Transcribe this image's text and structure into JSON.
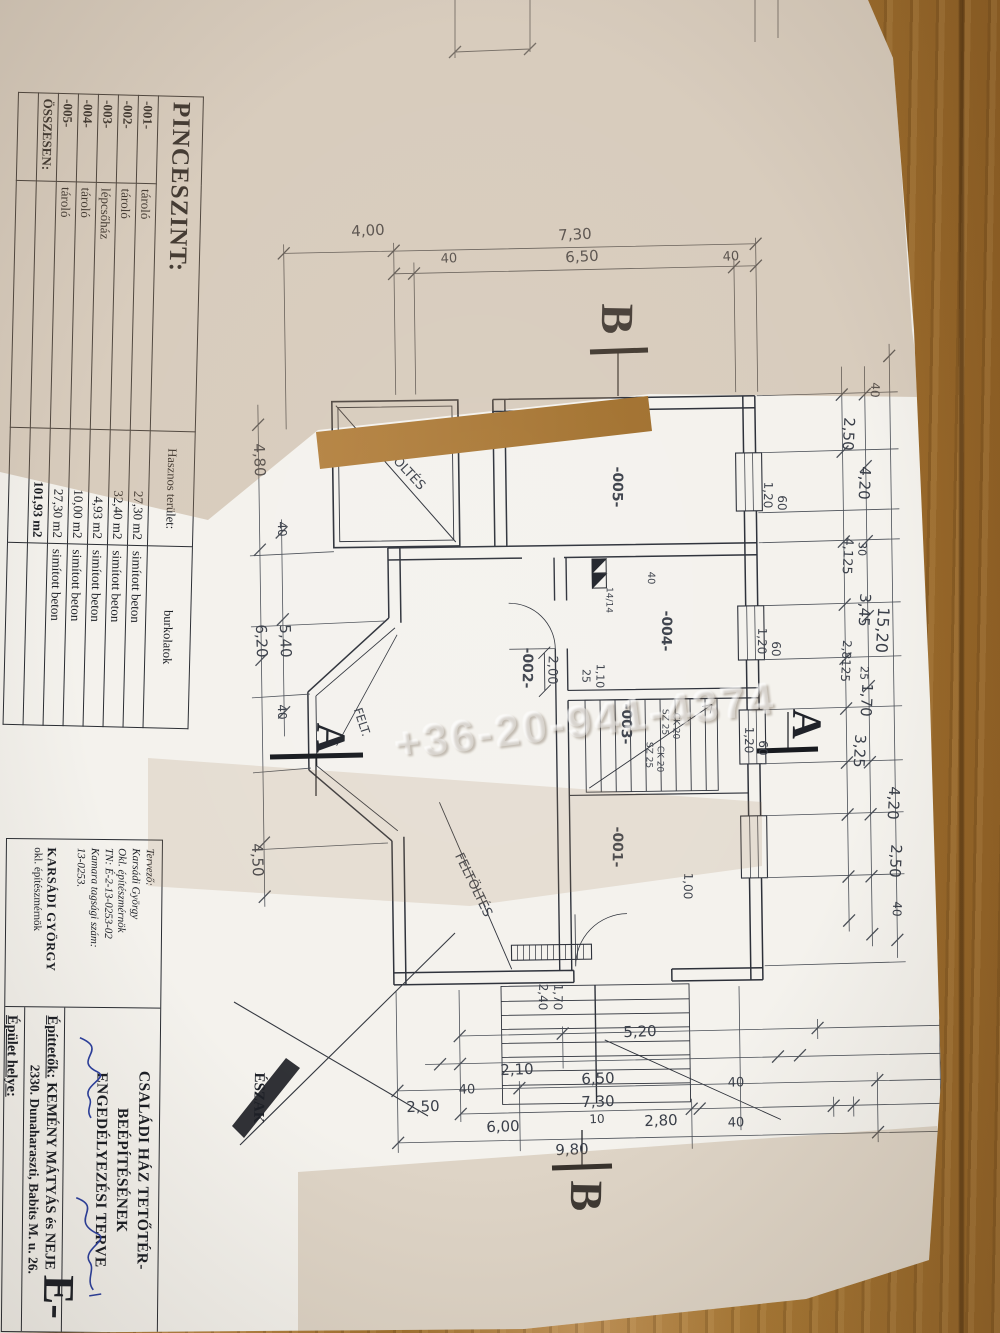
{
  "watermark": "+36-20-941-4374",
  "schedule_table": {
    "title": "PINCESZINT:",
    "area_header": "Hasznos terület:",
    "finish_header": "burkolatok",
    "rows": [
      {
        "code": "-001-",
        "name": "tároló",
        "area": "27,30 m2",
        "finish": "simított beton"
      },
      {
        "code": "-002-",
        "name": "tároló",
        "area": "32,40 m2",
        "finish": "simított beton"
      },
      {
        "code": "-003-",
        "name": "lépcsőház",
        "area": "4,93 m2",
        "finish": "simított beton"
      },
      {
        "code": "-004-",
        "name": "tároló",
        "area": "10,00 m2",
        "finish": "simított beton"
      },
      {
        "code": "-005-",
        "name": "tároló",
        "area": "27,30 m2",
        "finish": "simított beton"
      },
      {
        "code": "ÖSSZESEN:",
        "name": "",
        "area": "101,93 m2",
        "finish": "",
        "bold": true
      },
      {
        "code": "",
        "name": "",
        "area": "",
        "finish": ""
      }
    ]
  },
  "title_block": {
    "designer": {
      "lines": [
        "Tervező:",
        "Karsádi György",
        "Okl. építészmérnök",
        "TN: É-2-13-0253-02",
        "Kamara tagsági szám:",
        "13-0253."
      ],
      "stamp": [
        "KARSÁDI GYÖRGY",
        "okl. építészmérnök"
      ]
    },
    "title_line1": "CSALÁDI HÁZ TETŐTÉR-BEÉPÍTÉSÉNEK",
    "title_line2": "ENGEDÉLYEZÉSI TERVE",
    "clients_label": "Építtetők:",
    "clients": "KEMÉNY MÁTYÁS és NEJE",
    "clients_address": "2330. Dunaharaszti, Babits M. u. 26.",
    "site_label": "Épület helye:",
    "site_address": "2330. Dunaharaszti, Babits M. u. 26."
  },
  "labels": [
    {
      "t": "4,00",
      "x": 368,
      "y": 231,
      "r": -3
    },
    {
      "t": "7,30",
      "x": 575,
      "y": 235,
      "r": -3
    },
    {
      "t": "40",
      "x": 449,
      "y": 259,
      "r": -3,
      "s": 13
    },
    {
      "t": "6,50",
      "x": 582,
      "y": 257,
      "r": -3
    },
    {
      "t": "40",
      "x": 731,
      "y": 257,
      "r": -3,
      "s": 13
    },
    {
      "t": "4,80",
      "x": 259,
      "y": 460,
      "r": 88
    },
    {
      "t": "40",
      "x": 282,
      "y": 529,
      "r": 88,
      "s": 12
    },
    {
      "t": "6,20",
      "x": 261,
      "y": 641,
      "r": 88
    },
    {
      "t": "5,40",
      "x": 285,
      "y": 641,
      "r": 88
    },
    {
      "t": "40",
      "x": 282,
      "y": 712,
      "r": 88,
      "s": 12
    },
    {
      "t": "4,50",
      "x": 257,
      "y": 860,
      "r": 88
    },
    {
      "t": "40",
      "x": 875,
      "y": 390,
      "r": 93,
      "s": 12
    },
    {
      "t": "2,50",
      "x": 848,
      "y": 434,
      "r": 93
    },
    {
      "t": "4,20",
      "x": 864,
      "y": 483,
      "r": 93
    },
    {
      "t": "4,125",
      "x": 847,
      "y": 556,
      "r": 93,
      "s": 13
    },
    {
      "t": "30",
      "x": 862,
      "y": 549,
      "r": 93,
      "s": 11
    },
    {
      "t": "3,45",
      "x": 864,
      "y": 610,
      "r": 93
    },
    {
      "t": "15,20",
      "x": 882,
      "y": 630,
      "r": 93,
      "s": 16
    },
    {
      "t": "2,8125",
      "x": 846,
      "y": 661,
      "r": 93,
      "s": 12
    },
    {
      "t": "25",
      "x": 864,
      "y": 673,
      "r": 93,
      "s": 11
    },
    {
      "t": "1,70",
      "x": 866,
      "y": 700,
      "r": 93
    },
    {
      "t": "3,25",
      "x": 859,
      "y": 751,
      "r": 93
    },
    {
      "t": "4,20",
      "x": 893,
      "y": 803,
      "r": 93
    },
    {
      "t": "2,50",
      "x": 895,
      "y": 861,
      "r": 93
    },
    {
      "t": "40",
      "x": 897,
      "y": 909,
      "r": 93,
      "s": 12
    },
    {
      "t": "2,10",
      "x": 517,
      "y": 1070,
      "r": -2
    },
    {
      "t": "5,20",
      "x": 640,
      "y": 1032,
      "r": -2
    },
    {
      "t": "40",
      "x": 467,
      "y": 1090,
      "r": -2,
      "s": 13
    },
    {
      "t": "6,50",
      "x": 598,
      "y": 1079,
      "r": -2
    },
    {
      "t": "40",
      "x": 736,
      "y": 1083,
      "r": -2,
      "s": 13
    },
    {
      "t": "2,50",
      "x": 423,
      "y": 1107,
      "r": -2
    },
    {
      "t": "7,30",
      "x": 598,
      "y": 1102,
      "r": -2
    },
    {
      "t": "6,00",
      "x": 503,
      "y": 1127,
      "r": -2
    },
    {
      "t": "10",
      "x": 597,
      "y": 1119,
      "r": -2,
      "s": 12
    },
    {
      "t": "2,80",
      "x": 661,
      "y": 1121,
      "r": -2
    },
    {
      "t": "40",
      "x": 736,
      "y": 1123,
      "r": -2,
      "s": 13
    },
    {
      "t": "9,80",
      "x": 572,
      "y": 1150,
      "r": -2
    },
    {
      "t": "-001-",
      "x": 617,
      "y": 847,
      "r": 91,
      "n": "room-label",
      "s": 14,
      "b": 1
    },
    {
      "t": "-002-",
      "x": 527,
      "y": 668,
      "r": 91,
      "n": "room-label",
      "s": 14,
      "b": 1
    },
    {
      "t": "-003-",
      "x": 626,
      "y": 724,
      "r": 91,
      "n": "room-label",
      "s": 14,
      "b": 1
    },
    {
      "t": "-004-",
      "x": 666,
      "y": 631,
      "r": 91,
      "n": "room-label",
      "s": 14,
      "b": 1
    },
    {
      "t": "-005-",
      "x": 617,
      "y": 487,
      "r": 91,
      "n": "room-label",
      "s": 14,
      "b": 1
    },
    {
      "t": "FELTÖLTÉS",
      "x": 399,
      "y": 463,
      "r": 47,
      "s": 13,
      "n": "area-annotation"
    },
    {
      "t": "FELTÖLTÉS",
      "x": 473,
      "y": 885,
      "r": 64,
      "s": 13,
      "n": "area-annotation"
    },
    {
      "t": "FELT.",
      "x": 362,
      "y": 722,
      "r": 72,
      "s": 12,
      "n": "area-annotation"
    },
    {
      "t": "2,00",
      "x": 552,
      "y": 670,
      "r": 91,
      "s": 13
    },
    {
      "t": "25",
      "x": 586,
      "y": 676,
      "r": 91,
      "s": 11
    },
    {
      "t": "1,10",
      "x": 600,
      "y": 676,
      "r": 91,
      "s": 11
    },
    {
      "t": "40",
      "x": 650,
      "y": 578,
      "r": 91,
      "s": 10
    },
    {
      "t": "14/14",
      "x": 608,
      "y": 600,
      "r": 91,
      "s": 9
    },
    {
      "t": "SZ 25",
      "x": 664,
      "y": 722,
      "r": 91,
      "s": 9,
      "n": "stair-label"
    },
    {
      "t": "CK 20",
      "x": 675,
      "y": 726,
      "r": 91,
      "s": 9,
      "n": "stair-label"
    },
    {
      "t": "SZ 25",
      "x": 648,
      "y": 755,
      "r": 91,
      "s": 9,
      "n": "stair-label"
    },
    {
      "t": "CK 20",
      "x": 659,
      "y": 759,
      "r": 91,
      "s": 9,
      "n": "stair-label"
    },
    {
      "t": "1,00",
      "x": 688,
      "y": 886,
      "r": 91,
      "s": 12
    },
    {
      "t": "1,20",
      "x": 768,
      "y": 495,
      "r": 91,
      "s": 12,
      "n": "window-label"
    },
    {
      "t": "60",
      "x": 782,
      "y": 503,
      "r": 91,
      "s": 12,
      "n": "window-label"
    },
    {
      "t": "1,20",
      "x": 762,
      "y": 641,
      "r": 91,
      "s": 12,
      "n": "window-label"
    },
    {
      "t": "60",
      "x": 776,
      "y": 649,
      "r": 91,
      "s": 12,
      "n": "window-label"
    },
    {
      "t": "1,20",
      "x": 749,
      "y": 740,
      "r": 91,
      "s": 12,
      "n": "window-label"
    },
    {
      "t": "60",
      "x": 763,
      "y": 748,
      "r": 91,
      "s": 12,
      "n": "window-label"
    },
    {
      "t": "2,40",
      "x": 543,
      "y": 997,
      "r": 91,
      "s": 12
    },
    {
      "t": "1,70",
      "x": 558,
      "y": 997,
      "r": 91,
      "s": 12
    },
    {
      "t": "ÉSZAK",
      "x": 258,
      "y": 1098,
      "r": 91,
      "s": 15,
      "b": 1,
      "f": "p",
      "n": "north-label"
    },
    {
      "t": "B",
      "x": 617,
      "y": 319,
      "r": 91,
      "s": 46,
      "b": 1,
      "f": "p",
      "n": "section-marker"
    },
    {
      "t": "B",
      "x": 586,
      "y": 1196,
      "r": 91,
      "s": 46,
      "b": 1,
      "f": "p",
      "n": "section-marker"
    },
    {
      "t": "A",
      "x": 330,
      "y": 738,
      "r": 91,
      "s": 42,
      "b": 1,
      "f": "p",
      "n": "section-marker"
    },
    {
      "t": "A",
      "x": 806,
      "y": 724,
      "r": 91,
      "s": 42,
      "b": 1,
      "f": "p",
      "n": "section-marker"
    },
    {
      "t": "E-",
      "x": 58,
      "y": 1297,
      "r": 91,
      "s": 44,
      "b": 1,
      "f": "p",
      "n": "sheet-code"
    }
  ]
}
